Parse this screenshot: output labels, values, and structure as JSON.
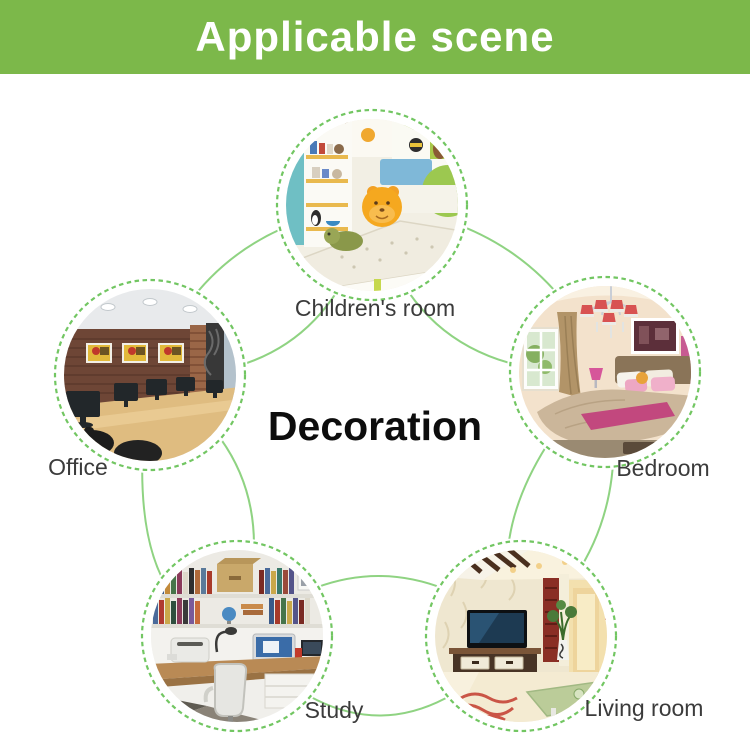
{
  "header": {
    "title": "Applicable scene"
  },
  "center": {
    "label": "Decoration"
  },
  "scenes": [
    {
      "id": "children-room",
      "label": "Children's room"
    },
    {
      "id": "bedroom",
      "label": "Bedroom"
    },
    {
      "id": "living-room",
      "label": "Living room"
    },
    {
      "id": "study",
      "label": "Study"
    },
    {
      "id": "office",
      "label": "Office"
    }
  ],
  "colors": {
    "header_bg": "#7cb84a",
    "header_text": "#ffffff",
    "connector_line": "#8fd382",
    "dashed_ring": "#72c662",
    "label_text": "#3b3b3b",
    "center_text": "#0d0d0d"
  }
}
